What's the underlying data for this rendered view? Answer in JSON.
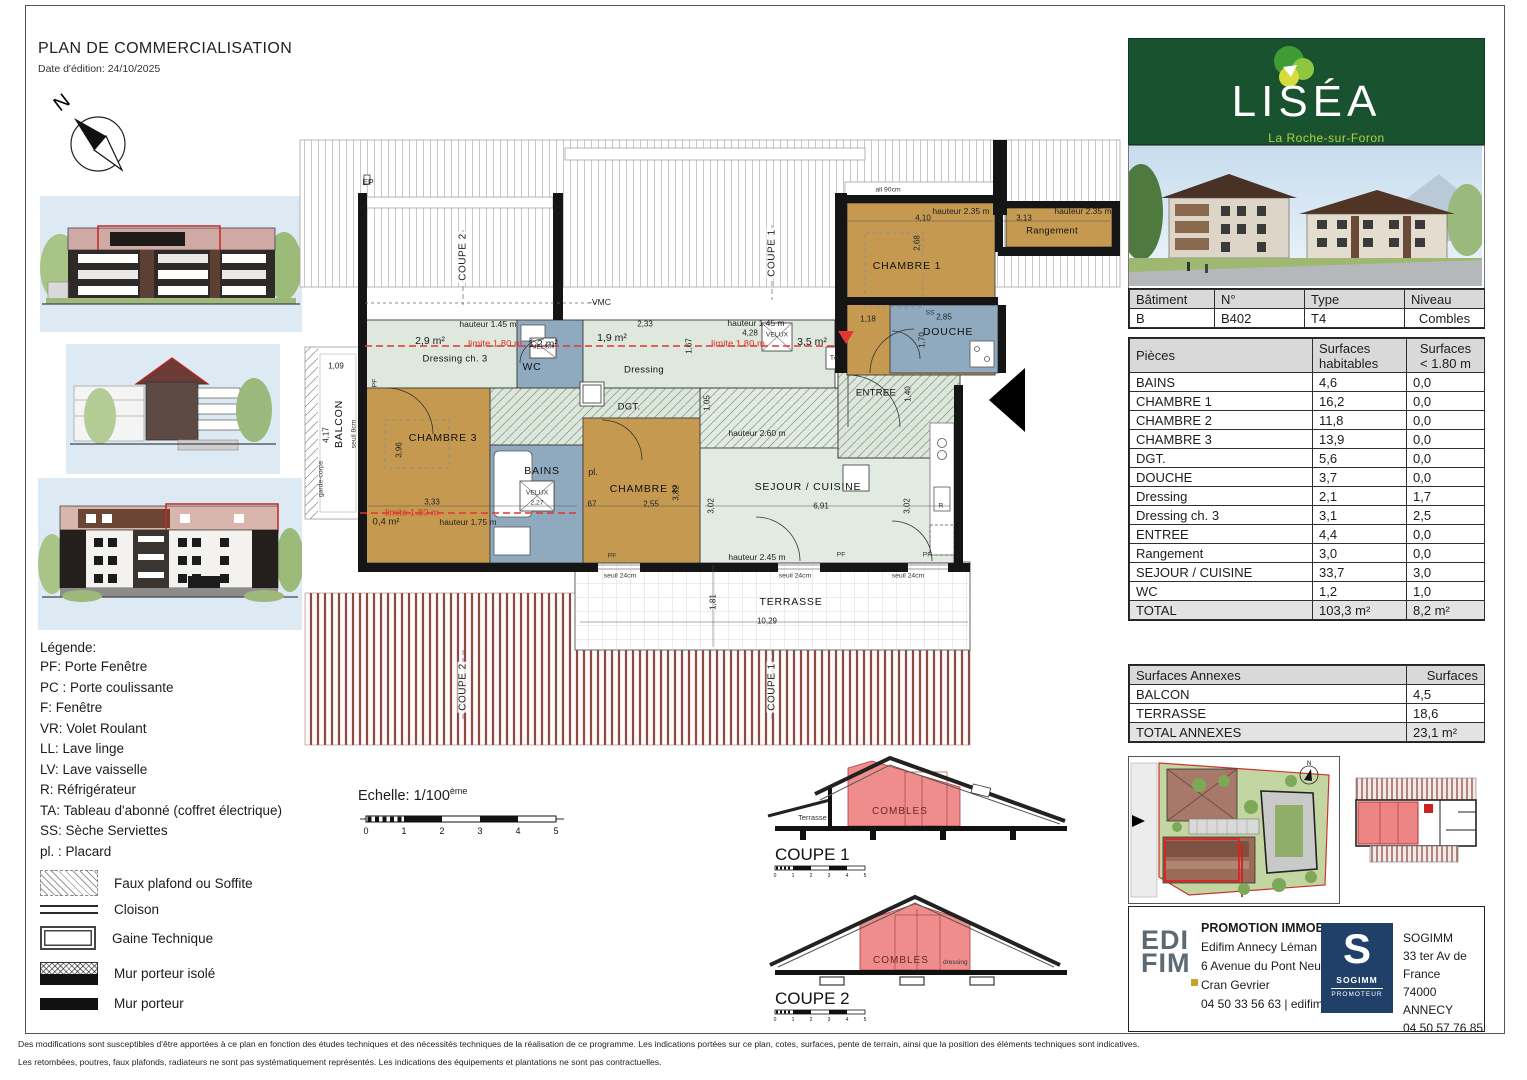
{
  "header": {
    "title": "PLAN DE COMMERCIALISATION",
    "date": "Date d'édition: 24/10/2025"
  },
  "compass": {
    "north": "N"
  },
  "logo": {
    "brand": "LISÉA",
    "city": "La Roche-sur-Foron"
  },
  "unit": {
    "headers": {
      "batiment": "Bâtiment",
      "numero": "N°",
      "type": "Type",
      "niveau": "Niveau"
    },
    "values": {
      "batiment": "B",
      "numero": "B402",
      "type": "T4",
      "niveau": "Combles"
    }
  },
  "rooms_table": {
    "col1": "Pièces",
    "col2a": "Surfaces",
    "col2b": "habitables",
    "col3a": "Surfaces",
    "col3b": "< 1.80 m",
    "rows": [
      [
        "BAINS",
        "4,6",
        "0,0"
      ],
      [
        "CHAMBRE 1",
        "16,2",
        "0,0"
      ],
      [
        "CHAMBRE 2",
        "11,8",
        "0,0"
      ],
      [
        "CHAMBRE 3",
        "13,9",
        "0,0"
      ],
      [
        "DGT.",
        "5,6",
        "0,0"
      ],
      [
        "DOUCHE",
        "3,7",
        "0,0"
      ],
      [
        "Dressing",
        "2,1",
        "1,7"
      ],
      [
        "Dressing ch. 3",
        "3,1",
        "2,5"
      ],
      [
        "ENTREE",
        "4,4",
        "0,0"
      ],
      [
        "Rangement",
        "3,0",
        "0,0"
      ],
      [
        "SEJOUR / CUISINE",
        "33,7",
        "3,0"
      ],
      [
        "WC",
        "1,2",
        "1,0"
      ]
    ],
    "total": [
      "TOTAL",
      "103,3 m²",
      "8,2 m²"
    ]
  },
  "annex_table": {
    "col1": "Surfaces Annexes",
    "col2": "Surfaces",
    "rows": [
      [
        "BALCON",
        "4,5"
      ],
      [
        "TERRASSE",
        "18,6"
      ]
    ],
    "total": [
      "TOTAL ANNEXES",
      "23,1 m²"
    ]
  },
  "legend": {
    "title": "Légende:",
    "abbreviations": [
      "PF: Porte Fenêtre",
      "PC : Porte coulissante",
      "F: Fenêtre",
      "VR: Volet Roulant",
      "LL: Lave linge",
      "LV: Lave vaisselle",
      "R: Réfrigérateur",
      "TA: Tableau d'abonné (coffret électrique)",
      "SS: Sèche Serviettes",
      "pl. : Placard"
    ],
    "symbols": [
      {
        "key": "faux-plafond",
        "label": "Faux plafond ou Soffite"
      },
      {
        "key": "cloison",
        "label": "Cloison"
      },
      {
        "key": "gaine-technique",
        "label": "Gaine Technique"
      },
      {
        "key": "mur-porteur-isole",
        "label": "Mur porteur isolé"
      },
      {
        "key": "mur-porteur",
        "label": "Mur porteur"
      }
    ]
  },
  "scale": {
    "label": "Echelle: 1/100",
    "sup": "ème",
    "ticks": [
      "0",
      "1",
      "2",
      "3",
      "4",
      "5"
    ]
  },
  "coupes": [
    {
      "label": "COUPE 1",
      "combles": "COMBLES",
      "terrasse": "Terrasse"
    },
    {
      "label": "COUPE 2",
      "combles": "COMBLES",
      "dressing": "dressing"
    }
  ],
  "plan": {
    "annotations": [
      {
        "n": "ep-label",
        "t": "EP",
        "x": 88,
        "y": 47,
        "c": "dim9"
      },
      {
        "n": "coupe2-cut-top",
        "t": "COUPE 2",
        "x": 183,
        "y": 122,
        "c": "cut vert"
      },
      {
        "n": "coupe1-cut-top",
        "t": "COUPE 1",
        "x": 492,
        "y": 118,
        "c": "cut vert"
      },
      {
        "n": "vmc-label",
        "t": "-VMC",
        "x": 320,
        "y": 167,
        "c": "dim9"
      },
      {
        "n": "allege-label",
        "t": "all 90cm",
        "x": 608,
        "y": 55,
        "c": "tiny"
      },
      {
        "n": "hauteur-145-a",
        "t": "hauteur 1.45 m",
        "x": 208,
        "y": 189,
        "c": "dim9"
      },
      {
        "n": "dim-233",
        "t": "2,33",
        "x": 365,
        "y": 189,
        "c": "dim"
      },
      {
        "n": "hauteur-145-b",
        "t": "hauteur 1.45 m",
        "x": 476,
        "y": 188,
        "c": "dim9"
      },
      {
        "n": "dim-428",
        "t": "4,28",
        "x": 470,
        "y": 198,
        "c": "dim"
      },
      {
        "n": "area-2-9",
        "t": "2,9 m²",
        "x": 150,
        "y": 206,
        "c": "area"
      },
      {
        "n": "limite-180-a",
        "t": "limite 1.80 m",
        "x": 215,
        "y": 209,
        "c": "red"
      },
      {
        "n": "area-1-2",
        "t": "1,2 m²",
        "x": 263,
        "y": 209,
        "c": "area"
      },
      {
        "n": "area-1-9",
        "t": "1,9 m²",
        "x": 332,
        "y": 203,
        "c": "area"
      },
      {
        "n": "limite-180-b",
        "t": "limite 1.80 m",
        "x": 458,
        "y": 209,
        "c": "red"
      },
      {
        "n": "area-3-5",
        "t": "3,5 m²",
        "x": 532,
        "y": 207,
        "c": "area"
      },
      {
        "n": "velux-corridor-label",
        "t": "VELUX",
        "x": 497,
        "y": 200,
        "c": "tiny"
      },
      {
        "n": "dressing-ch3-label",
        "t": "Dressing ch. 3",
        "x": 175,
        "y": 224,
        "c": "room9"
      },
      {
        "n": "wc-label",
        "t": "WC",
        "x": 252,
        "y": 232,
        "c": "room"
      },
      {
        "n": "velux-wc-label",
        "t": "VELUX",
        "x": 263,
        "y": 212,
        "c": "tiny"
      },
      {
        "n": "dressing-label",
        "t": "Dressing",
        "x": 364,
        "y": 235,
        "c": "room9"
      },
      {
        "n": "dim-167-v",
        "t": "1,67",
        "x": 409,
        "y": 211,
        "c": "dim vert"
      },
      {
        "n": "dim-109",
        "t": "1,09",
        "x": 56,
        "y": 231,
        "c": "dim"
      },
      {
        "n": "hauteur-235-a",
        "t": "hauteur 2.35 m",
        "x": 681,
        "y": 76,
        "c": "dim9"
      },
      {
        "n": "dim-410",
        "t": "4,10",
        "x": 643,
        "y": 83,
        "c": "dim"
      },
      {
        "n": "dim-313",
        "t": "3,13",
        "x": 744,
        "y": 83,
        "c": "dim"
      },
      {
        "n": "hauteur-235-b",
        "t": "hauteur 2.35 m",
        "x": 803,
        "y": 76,
        "c": "dim9"
      },
      {
        "n": "rangement-label",
        "t": "Rangement",
        "x": 772,
        "y": 96,
        "c": "room9"
      },
      {
        "n": "chambre1-label",
        "t": "CHAMBRE 1",
        "x": 627,
        "y": 131,
        "c": "room"
      },
      {
        "n": "dim-268-v",
        "t": "2,68",
        "x": 637,
        "y": 108,
        "c": "dim vert"
      },
      {
        "n": "dim-118",
        "t": "1,18",
        "x": 588,
        "y": 184,
        "c": "dim"
      },
      {
        "n": "ss-label",
        "t": "SS",
        "x": 650,
        "y": 178,
        "c": "tiny"
      },
      {
        "n": "dim-285",
        "t": "2,85",
        "x": 664,
        "y": 182,
        "c": "dim"
      },
      {
        "n": "douche-label",
        "t": "DOUCHE",
        "x": 668,
        "y": 197,
        "c": "room"
      },
      {
        "n": "dim-170-v",
        "t": "1,70",
        "x": 642,
        "y": 205,
        "c": "dim vert"
      },
      {
        "n": "entree-label",
        "t": "ENTREE",
        "x": 596,
        "y": 258,
        "c": "room9"
      },
      {
        "n": "dim-140-v",
        "t": "1,40",
        "x": 628,
        "y": 259,
        "c": "dim vert"
      },
      {
        "n": "ta-label",
        "t": "TA",
        "x": 554,
        "y": 223,
        "c": "tiny"
      },
      {
        "n": "balcon-label",
        "t": "BALCON",
        "x": 59,
        "y": 289,
        "c": "room vert"
      },
      {
        "n": "dim-417-v",
        "t": "4,17",
        "x": 46,
        "y": 300,
        "c": "dim vert"
      },
      {
        "n": "seuil-8-label",
        "t": "seuil 8cm",
        "x": 74,
        "y": 299,
        "c": "tiny vert"
      },
      {
        "n": "garde-corps-label",
        "t": "garde-corps",
        "x": 41,
        "y": 344,
        "c": "tiny vert"
      },
      {
        "n": "dgt-label",
        "t": "DGT.",
        "x": 349,
        "y": 272,
        "c": "room9"
      },
      {
        "n": "dim-105-v",
        "t": "1,05",
        "x": 427,
        "y": 268,
        "c": "dim vert"
      },
      {
        "n": "pf-chambre3",
        "t": "PF",
        "x": 95,
        "y": 248,
        "c": "tiny vert"
      },
      {
        "n": "chambre3-label",
        "t": "CHAMBRE 3",
        "x": 163,
        "y": 303,
        "c": "room"
      },
      {
        "n": "dim-396-v",
        "t": "3,96",
        "x": 119,
        "y": 315,
        "c": "dim vert"
      },
      {
        "n": "dim-333",
        "t": "3,33",
        "x": 152,
        "y": 367,
        "c": "dim"
      },
      {
        "n": "bains-label",
        "t": "BAINS",
        "x": 262,
        "y": 336,
        "c": "room"
      },
      {
        "n": "velux-bains-label",
        "t": "VELUX",
        "x": 257,
        "y": 358,
        "c": "tiny"
      },
      {
        "n": "dim-227",
        "t": "2,27",
        "x": 257,
        "y": 368,
        "c": "tiny"
      },
      {
        "n": "pl-label",
        "t": "pl.",
        "x": 313,
        "y": 337,
        "c": "small9"
      },
      {
        "n": "chambre2-label",
        "t": "CHAMBRE 2",
        "x": 364,
        "y": 354,
        "c": "room"
      },
      {
        "n": "dim-382-v",
        "t": "3,82",
        "x": 396,
        "y": 358,
        "c": "dim vert"
      },
      {
        "n": "dim-67",
        "t": "67",
        "x": 312,
        "y": 369,
        "c": "dim"
      },
      {
        "n": "dim-255",
        "t": "2,55",
        "x": 371,
        "y": 369,
        "c": "dim"
      },
      {
        "n": "sejour-label",
        "t": "SEJOUR / CUISINE",
        "x": 528,
        "y": 352,
        "c": "room"
      },
      {
        "n": "dim-691",
        "t": "6,91",
        "x": 541,
        "y": 371,
        "c": "dim"
      },
      {
        "n": "dim-302-va",
        "t": "3,02",
        "x": 431,
        "y": 371,
        "c": "dim vert"
      },
      {
        "n": "dim-302-vb",
        "t": "3,02",
        "x": 627,
        "y": 371,
        "c": "dim vert"
      },
      {
        "n": "r-label",
        "t": "R",
        "x": 661,
        "y": 371,
        "c": "tiny"
      },
      {
        "n": "limite-180-c",
        "t": "limite 1.80 m",
        "x": 132,
        "y": 378,
        "c": "red"
      },
      {
        "n": "area-0-4",
        "t": "0,4 m²",
        "x": 106,
        "y": 387,
        "c": "area9"
      },
      {
        "n": "hauteur-175",
        "t": "hauteur 1.75 m",
        "x": 188,
        "y": 387,
        "c": "dim9"
      },
      {
        "n": "hauteur-260",
        "t": "hauteur 2.60 m",
        "x": 477,
        "y": 298,
        "c": "dim9"
      },
      {
        "n": "hauteur-245",
        "t": "hauteur 2.45 m",
        "x": 477,
        "y": 422,
        "c": "dim9"
      },
      {
        "n": "pf-sejour-a",
        "t": "PF",
        "x": 332,
        "y": 421,
        "c": "tiny"
      },
      {
        "n": "pf-sejour-b",
        "t": "PF",
        "x": 561,
        "y": 420,
        "c": "tiny"
      },
      {
        "n": "pf-sejour-c",
        "t": "PF",
        "x": 647,
        "y": 420,
        "c": "tiny"
      },
      {
        "n": "seuil-24-a",
        "t": "seuil 24cm",
        "x": 340,
        "y": 441,
        "c": "tiny"
      },
      {
        "n": "seuil-24-b",
        "t": "seuil 24cm",
        "x": 515,
        "y": 441,
        "c": "tiny"
      },
      {
        "n": "seuil-24-c",
        "t": "seuil 24cm",
        "x": 628,
        "y": 441,
        "c": "tiny"
      },
      {
        "n": "terrasse-label",
        "t": "TERRASSE",
        "x": 511,
        "y": 467,
        "c": "room"
      },
      {
        "n": "dim-1029",
        "t": "10,29",
        "x": 487,
        "y": 486,
        "c": "dim"
      },
      {
        "n": "dim-181-v",
        "t": "1,81",
        "x": 433,
        "y": 467,
        "c": "dim vert"
      },
      {
        "n": "coupe2-cut-bottom",
        "t": "COUPE 2",
        "x": 183,
        "y": 552,
        "c": "cut vert"
      },
      {
        "n": "coupe1-cut-bottom",
        "t": "COUPE 1",
        "x": 492,
        "y": 552,
        "c": "cut vert"
      }
    ]
  },
  "promoters": {
    "edifim": {
      "logo_top": "EDI",
      "logo_bottom": "FIM",
      "line1": "PROMOTION IMMOBILIERE",
      "line2": "Edifim Annecy Léman",
      "line3": "6 Avenue du Pont Neuf",
      "line4": "Cran Gevrier",
      "line5": "04 50 33 56 63 | edifim.fr"
    },
    "sogimm": {
      "logo_letter": "S",
      "logo_name": "SOGIMM",
      "logo_sub": "PROMOTEUR",
      "line1": "SOGIMM",
      "line2": "33 ter Av de France",
      "line3": "74000 ANNECY",
      "line4": "04 50 57 76 85"
    }
  },
  "footer": {
    "line1": "Des modifications sont susceptibles d'être apportées à ce plan en fonction des études techniques et des nécessités techniques de la réalisation de ce programme. Les indications portées sur ce plan, cotes, surfaces, pente de terrain, ainsi que la position des éléments techniques sont indicatives.",
    "line2": "Les retombées, poutres, faux plafonds, radiateurs ne sont pas systématiquement représentés. Les indications des équipements et plantations ne sont pas contractuelles."
  },
  "colors": {
    "room_tan": "#c59a50",
    "room_green": "#dee8dd",
    "room_blue": "#8faabf",
    "accent_red": "#e02f2f",
    "combles_red": "#ef8d8d",
    "stripe_maroon": "#8e4a42",
    "logo_green": "#18522f",
    "logo_lime": "#b5cf3f",
    "sogimm_navy": "#20406a"
  }
}
